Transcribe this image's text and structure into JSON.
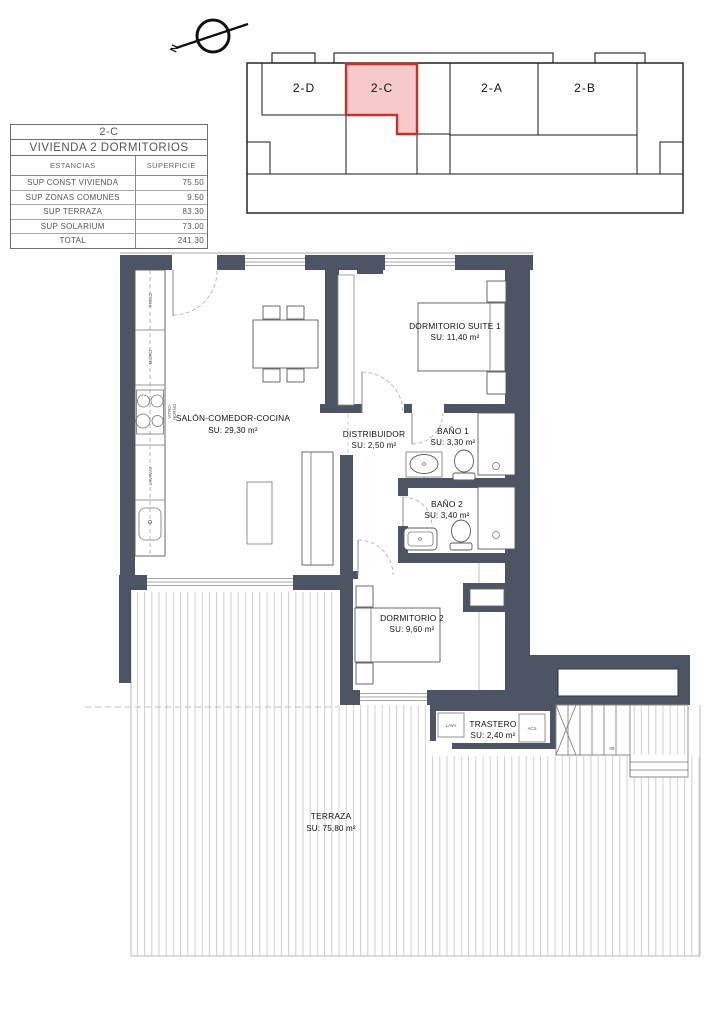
{
  "compass": {
    "label": "N"
  },
  "key_plan": {
    "units": [
      {
        "id": "2-D",
        "highlighted": false
      },
      {
        "id": "2-C",
        "highlighted": true
      },
      {
        "id": "2-A",
        "highlighted": false
      },
      {
        "id": "2-B",
        "highlighted": false
      }
    ]
  },
  "summary_table": {
    "unit": "2-C",
    "title": "VIVIENDA 2 DORMITORIOS",
    "columns": [
      "ESTANCIAS",
      "SUPERFICIE"
    ],
    "rows": [
      {
        "label": "SUP CONST VIVIENDA",
        "value": "75.50"
      },
      {
        "label": "SUP ZONAS COMUNES",
        "value": "9.50"
      },
      {
        "label": "SUP TERRAZA",
        "value": "83.30"
      },
      {
        "label": "SUP SOLARIUM",
        "value": "73.00"
      },
      {
        "label": "TOTAL",
        "value": "241.30"
      }
    ]
  },
  "rooms": [
    {
      "name": "DORMITORIO SUITE 1",
      "area": "SU: 11,40 m²"
    },
    {
      "name": "SALÓN-COMEDOR-COCINA",
      "area": "SU: 29,30 m²"
    },
    {
      "name": "DISTRIBUIDOR",
      "area": "SU: 2,50 m²"
    },
    {
      "name": "BAÑO 1",
      "area": "SU: 3,30 m²"
    },
    {
      "name": "BAÑO 2",
      "area": "SU: 3,40 m²"
    },
    {
      "name": "DORMITORIO 2",
      "area": "SU: 9,60 m²"
    },
    {
      "name": "TRASTERO",
      "area": "SU: 2,40 m²"
    },
    {
      "name": "TERRAZA",
      "area": "SU: 75,80 m²"
    }
  ],
  "kitchen": {
    "fridge": "FRIGO",
    "micro": "MICRO",
    "vitro": "VITRO",
    "horno": "HORNO",
    "dishwasher": "LAVAVAJ"
  },
  "utility": {
    "washer": "LAVA",
    "water_heater": "ACS"
  },
  "stairs": {
    "step_label": "08"
  },
  "colors": {
    "wall": "#4d5564",
    "highlight_fill": "#f6caca",
    "highlight_stroke": "#c9302c",
    "terrace_stripe": "#cfcfcf"
  }
}
